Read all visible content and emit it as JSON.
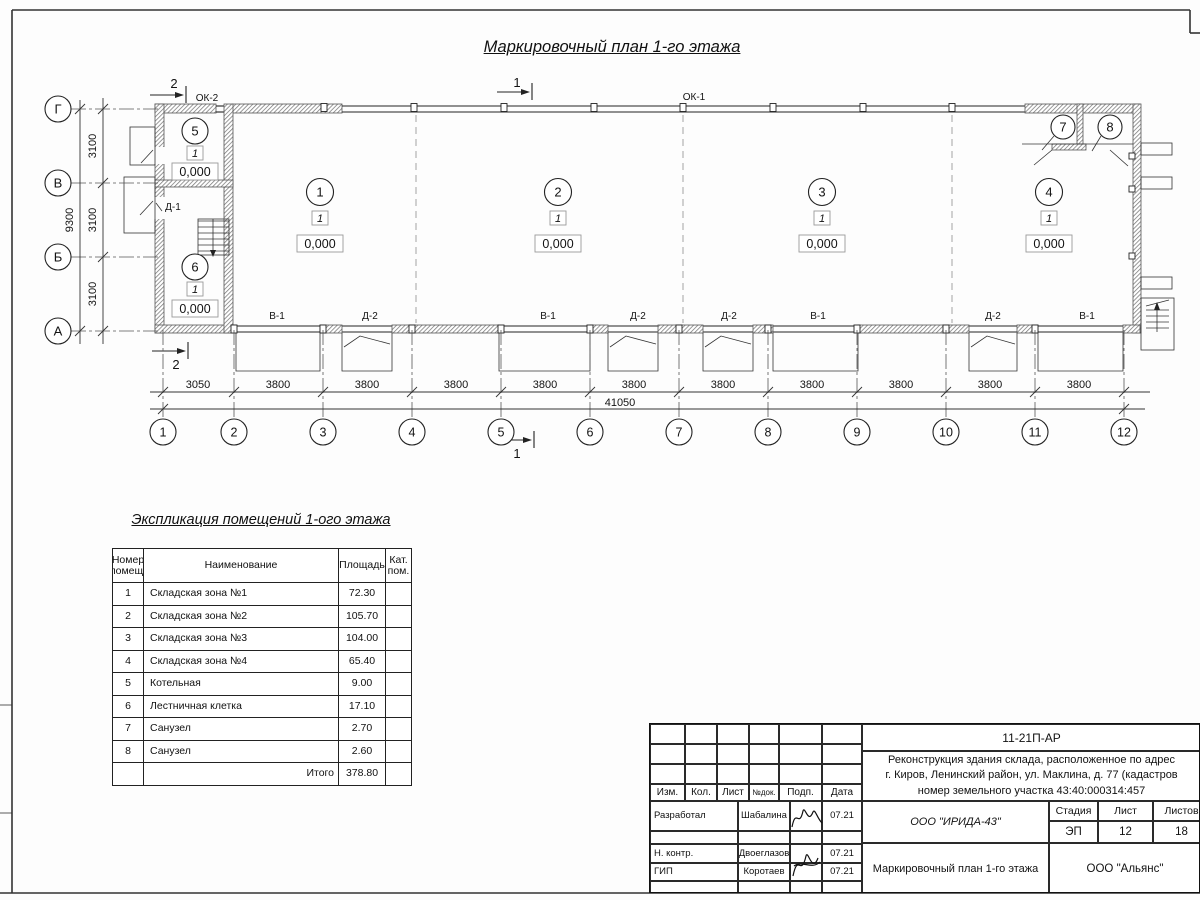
{
  "title": "Маркировочный план 1-го этажа",
  "plan": {
    "row_axes": [
      "Г",
      "В",
      "Б",
      "А"
    ],
    "col_axes": [
      "1",
      "2",
      "3",
      "4",
      "5",
      "6",
      "7",
      "8",
      "9",
      "10",
      "11",
      "12"
    ],
    "v_dims": [
      "3100",
      "3100",
      "3100"
    ],
    "v_total": "9300",
    "h_dims": [
      "3050",
      "3800",
      "3800",
      "3800",
      "3800",
      "3800",
      "3800",
      "3800",
      "3800",
      "3800",
      "3800"
    ],
    "h_total": "41050",
    "window_label_1": "ОК-1",
    "window_label_2": "ОК-2",
    "door_label_1": "Д-1",
    "section_mark_1": "1",
    "section_mark_2": "2",
    "rooms": [
      {
        "num": "1",
        "cat": "1",
        "elev": "0,000"
      },
      {
        "num": "2",
        "cat": "1",
        "elev": "0,000"
      },
      {
        "num": "3",
        "cat": "1",
        "elev": "0,000"
      },
      {
        "num": "4",
        "cat": "1",
        "elev": "0,000"
      },
      {
        "num": "5",
        "cat": "1",
        "elev": "0,000"
      },
      {
        "num": "6",
        "cat": "1",
        "elev": "0,000"
      }
    ],
    "wc_nums": [
      "7",
      "8"
    ],
    "bottom_labels": [
      "В-1",
      "Д-2",
      "В-1",
      "Д-2",
      "Д-2",
      "В-1",
      "Д-2",
      "В-1"
    ]
  },
  "schedule": {
    "title": "Экспликация помещений 1-ого этажа",
    "col_num": "Номер помещ.",
    "col_name": "Наименование",
    "col_area": "Площадь",
    "col_cat": "Кат. пом.",
    "rows": [
      {
        "num": "1",
        "name": "Складская зона №1",
        "area": "72.30"
      },
      {
        "num": "2",
        "name": "Складская зона №2",
        "area": "105.70"
      },
      {
        "num": "3",
        "name": "Складская зона №3",
        "area": "104.00"
      },
      {
        "num": "4",
        "name": "Складская зона №4",
        "area": "65.40"
      },
      {
        "num": "5",
        "name": "Котельная",
        "area": "9.00"
      },
      {
        "num": "6",
        "name": "Лестничная клетка",
        "area": "17.10"
      },
      {
        "num": "7",
        "name": "Санузел",
        "area": "2.70"
      },
      {
        "num": "8",
        "name": "Санузел",
        "area": "2.60"
      }
    ],
    "total_label": "Итого",
    "total_area": "378.80"
  },
  "stamp": {
    "doc_number": "11-21П-АР",
    "project_line_1": "Реконструкция здания склада, расположенное по адрес",
    "project_line_2": "г. Киров, Ленинский район, ул. Маклина, д. 77 (кадастров",
    "project_line_3": "номер земельного участка 43:40:000314:457",
    "cols": [
      "Изм.",
      "Кол.",
      "Лист",
      "№док.",
      "Подп.",
      "Дата"
    ],
    "stage_label": "Стадия",
    "sheet_label": "Лист",
    "sheets_label": "Листов",
    "stage": "ЭП",
    "sheet": "12",
    "sheets": "18",
    "org_design": "ООО \"ИРИДА-43\"",
    "drawing_title": "Маркировочный план 1-го этажа",
    "org_customer": "ООО \"Альянс\"",
    "roles": [
      {
        "role": "Разработал",
        "name": "Шабалина",
        "date": "07.21"
      },
      {
        "role": "Н. контр.",
        "name": "Двоеглазов",
        "date": "07.21"
      },
      {
        "role": "ГИП",
        "name": "Коротаев",
        "date": "07.21"
      }
    ]
  }
}
